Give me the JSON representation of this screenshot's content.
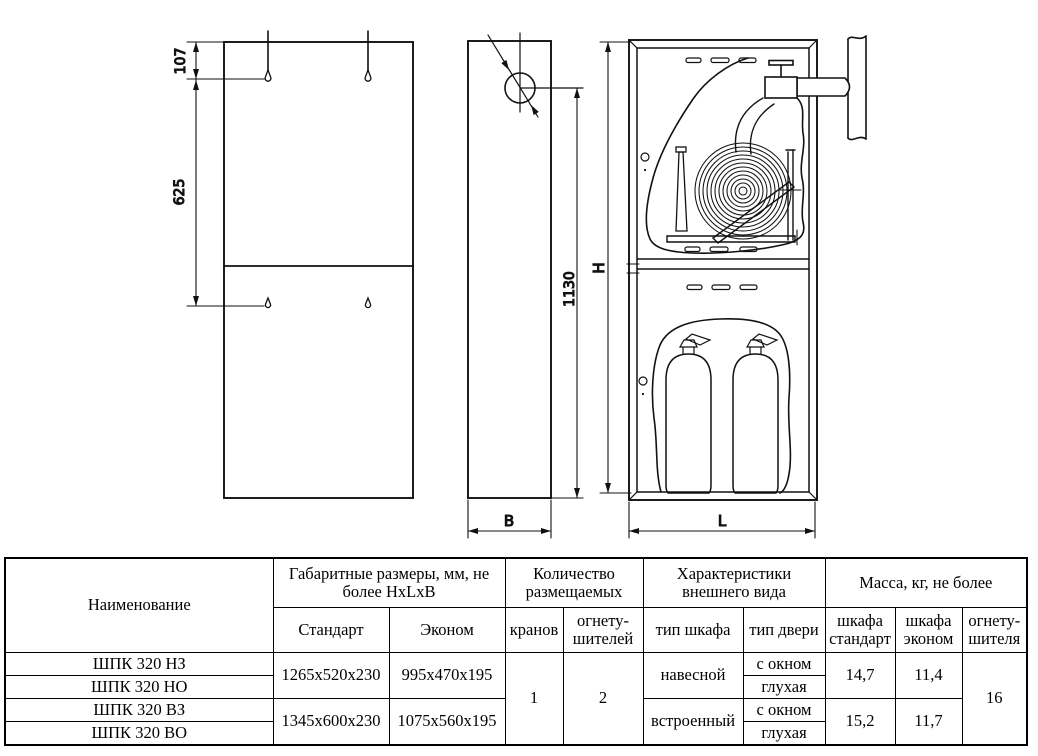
{
  "drawing": {
    "dimension_labels": {
      "hole_offset_top": "107",
      "hole_spacing": "625",
      "valve_height": "1130",
      "depth": "B",
      "height": "H",
      "width": "L"
    }
  },
  "table": {
    "headers": {
      "name": "Наименование",
      "dimensions_group": "Габаритные размеры, мм, не более HxLxB",
      "dim_standard": "Стандарт",
      "dim_econom": "Эконом",
      "quantity_group": "Количество размещаемых",
      "qty_taps": "кранов",
      "qty_extinguishers": "огнету-\nшителей",
      "appearance_group": "Характеристики внешнего вида",
      "cabinet_type": "тип шкафа",
      "door_type": "тип двери",
      "mass_group": "Масса, кг, не более",
      "mass_standard": "шкафа\nстандарт",
      "mass_econom": "шкафа\nэконом",
      "mass_extinguisher": "огнету-\nшителя"
    },
    "rows": [
      {
        "name": "ШПК 320 НЗ"
      },
      {
        "name": "ШПК 320 НО"
      },
      {
        "name": "ШПК 320 ВЗ"
      },
      {
        "name": "ШПК 320 ВО"
      }
    ],
    "size_groups": [
      {
        "standard": "1265x520x230",
        "econom": "995x470x195"
      },
      {
        "standard": "1345x600x230",
        "econom": "1075x560x195"
      }
    ],
    "taps_count": "1",
    "extinguishers_count": "2",
    "cabinet_types": [
      "навесной",
      "встроенный"
    ],
    "door_types": [
      "с окном",
      "глухая",
      "с окном",
      "глухая"
    ],
    "mass_groups": [
      {
        "standard": "14,7",
        "econom": "11,4"
      },
      {
        "standard": "15,2",
        "econom": "11,7"
      }
    ],
    "extinguisher_mass": "16"
  }
}
